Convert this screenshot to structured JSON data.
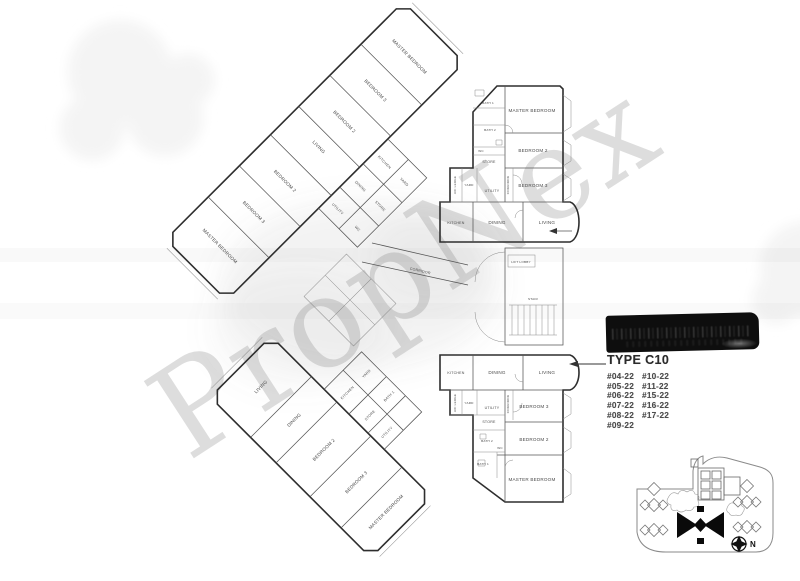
{
  "document": {
    "kind": "floor-plan-scan",
    "background": "#ffffff"
  },
  "watermark": {
    "text": "PropNex",
    "color": "#c9c9c9"
  },
  "redaction_bar": {
    "color": "#0e0e0e"
  },
  "type_block": {
    "title": "TYPE C10",
    "units_col1": [
      "#04-22",
      "#05-22",
      "#06-22",
      "#07-22",
      "#08-22",
      "#09-22"
    ],
    "units_col2": [
      "#10-22",
      "#11-22",
      "#15-22",
      "#16-22",
      "#17-22"
    ]
  },
  "floor_plan": {
    "labels": {
      "master_bedroom": "MASTER BEDROOM",
      "bedroom_2": "BEDROOM 2",
      "bedroom_3": "BEDROOM 3",
      "living": "LIVING",
      "dining": "DINING",
      "kitchen": "KITCHEN",
      "yard": "YARD",
      "utility": "UTILITY",
      "store": "STORE",
      "corridor": "CORRIDOR",
      "bath_1": "BATH 1",
      "bath_2": "BATH 2",
      "wc": "WC",
      "ac_ledge": "A/C LEDGE",
      "lift_lobby": "LIFT LOBBY",
      "stair": "STAIR"
    }
  },
  "site_plan": {
    "north_label": "N",
    "highlight_color": "#0a0a0a"
  }
}
